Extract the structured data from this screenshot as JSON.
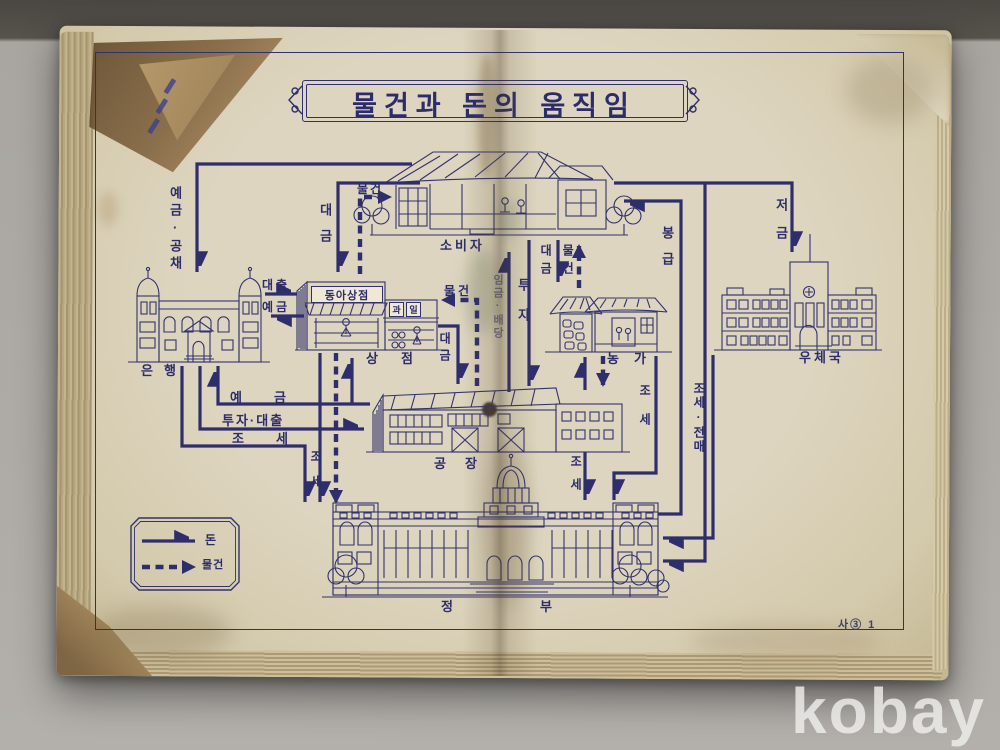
{
  "title": "물건과 돈의 움직임",
  "page_number": "사③ 1",
  "watermark": "kobay",
  "legend": {
    "money": "돈",
    "goods": "물건"
  },
  "buildings": {
    "consumer": "소비자",
    "bank": "은행",
    "store": "상점",
    "farm": "농가",
    "post_office": "우체국",
    "factory": "공장",
    "government_1": "정",
    "government_2": "부"
  },
  "signs": {
    "store_main": "동아상점",
    "fruit_1": "과",
    "fruit_2": "일"
  },
  "flows": {
    "deposits_bonds": "예금·공채",
    "payment_consumer_store": "대금",
    "goods_store_consumer": "물건",
    "loan": "대출",
    "deposit_store_bank": "예금",
    "goods_factory_store": "물건",
    "payment_store_factory": "대금",
    "wages_dividends": "임금·배당",
    "investment": "투자",
    "payment_consumer_farm": "대금",
    "goods_farm_consumer": "물건",
    "salary": "봉급",
    "savings": "저금",
    "deposit_factory_bank": "예금",
    "investment_loan": "투자·대출",
    "tax_bank": "조세",
    "tax_bank_down": "조세",
    "tax_factory": "조세",
    "tax_farm": "조세",
    "tax_monopoly": "조세·전매"
  }
}
